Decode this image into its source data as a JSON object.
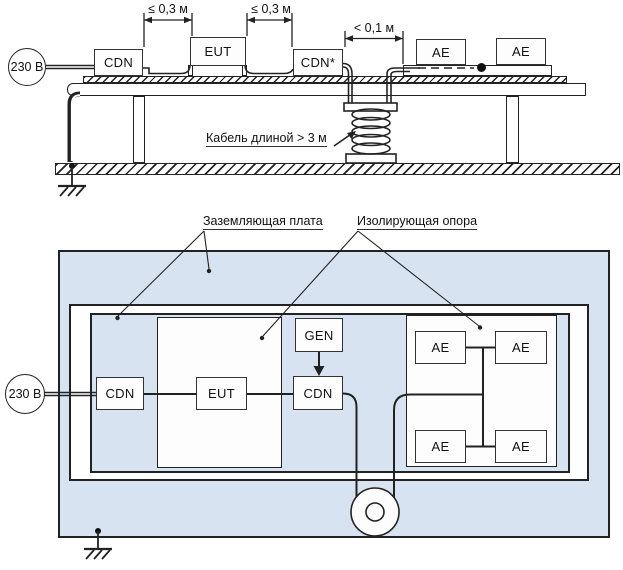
{
  "top_view": {
    "source_label": "230 В",
    "dim_left": "≤ 0,3 м",
    "dim_mid": "≤ 0,3 м",
    "dim_right": "< 0,1 м",
    "cable_note": "Кабель длиной > 3 м",
    "boxes": {
      "cdn": "CDN",
      "eut": "EUT",
      "cdn_star": "CDN*",
      "ae1": "AE",
      "ae2": "AE"
    }
  },
  "plan_view": {
    "source_label": "230 В",
    "ground_plate_label": "Заземляющая плата",
    "insulating_support_label": "Изолирующая опора",
    "boxes": {
      "cdn_left": "CDN",
      "eut": "EUT",
      "gen": "GEN",
      "cdn_mid": "CDN",
      "ae_top_left": "AE",
      "ae_top_right": "AE",
      "ae_bottom_left": "AE",
      "ae_bottom_right": "AE"
    }
  },
  "colors": {
    "plate_fill": "#d8e3f1",
    "line": "#222222",
    "box_fill": "#ffffff"
  }
}
